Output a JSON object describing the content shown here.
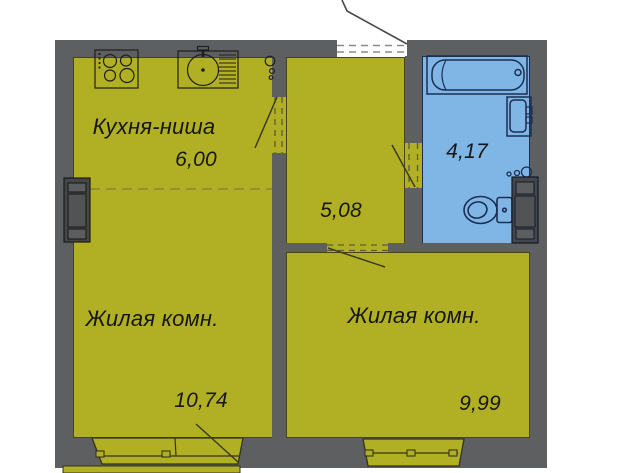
{
  "plan": {
    "title": "apartment-floor-plan",
    "rooms": [
      {
        "id": "kitchen",
        "label": "Кухня-ниша",
        "area": "6,00"
      },
      {
        "id": "hallway",
        "label": "",
        "area": "5,08"
      },
      {
        "id": "bathroom",
        "label": "",
        "area": "4,17"
      },
      {
        "id": "living_left",
        "label": "Жилая комн.",
        "area": "10,74"
      },
      {
        "id": "living_right",
        "label": "Жилая комн.",
        "area": "9,99"
      }
    ],
    "colors": {
      "wall": "#5e5f61",
      "room_fill": "#b1b025",
      "bathroom_fill": "#7fb6e6",
      "bathroom_outline": "#1c2e52",
      "text": "#161616"
    },
    "fixtures": [
      "stove-icon",
      "sink-icon",
      "bathtub-icon",
      "washbasin-icon",
      "toilet-icon",
      "outlet-icon",
      "wardrobe-icon",
      "duct-icon",
      "window",
      "balcony-door",
      "entrance-door"
    ]
  }
}
